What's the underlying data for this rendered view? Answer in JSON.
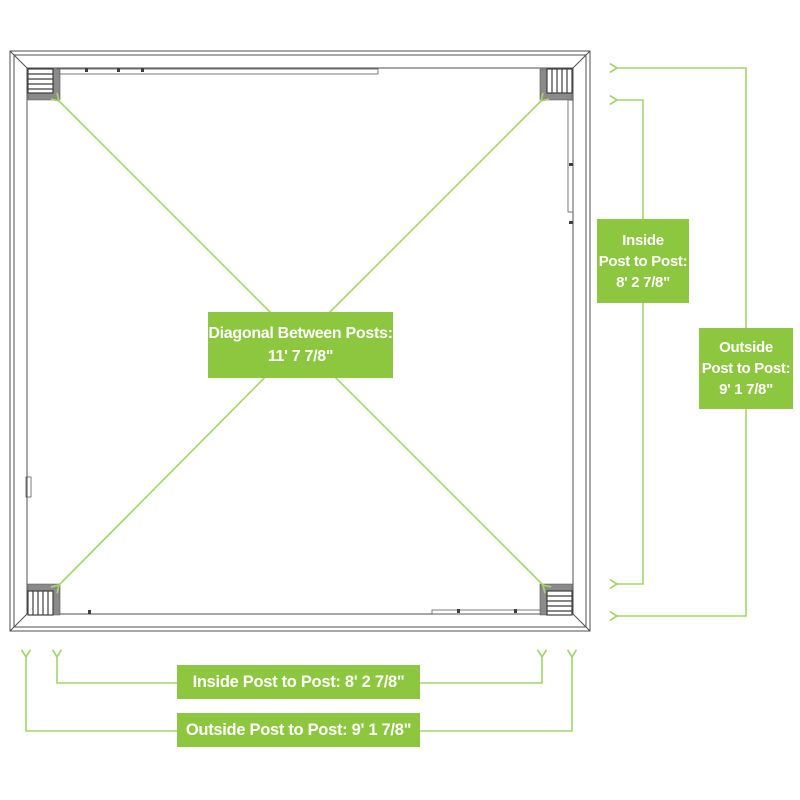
{
  "colors": {
    "green_box": "#8dc63f",
    "green_line": "#a6d36c",
    "frame_line": "#4f4f4f"
  },
  "labels": {
    "diagonal": {
      "line1": "Diagonal Between Posts:",
      "line2": "11' 7 7/8\""
    },
    "right_inside": {
      "line1": "Inside",
      "line2": "Post to Post:",
      "line3": "8' 2 7/8\""
    },
    "right_outside": {
      "line1": "Outside",
      "line2": "Post to Post:",
      "line3": "9' 1 7/8\""
    },
    "bottom_inside": {
      "text": "Inside Post to Post: 8' 2 7/8\""
    },
    "bottom_outside": {
      "text": "Outside Post to Post: 9' 1 7/8\""
    }
  },
  "measurements": {
    "diagonal_between_posts": "11' 7 7/8\"",
    "inside_post_to_post": "8' 2 7/8\"",
    "outside_post_to_post": "9' 1 7/8\""
  }
}
